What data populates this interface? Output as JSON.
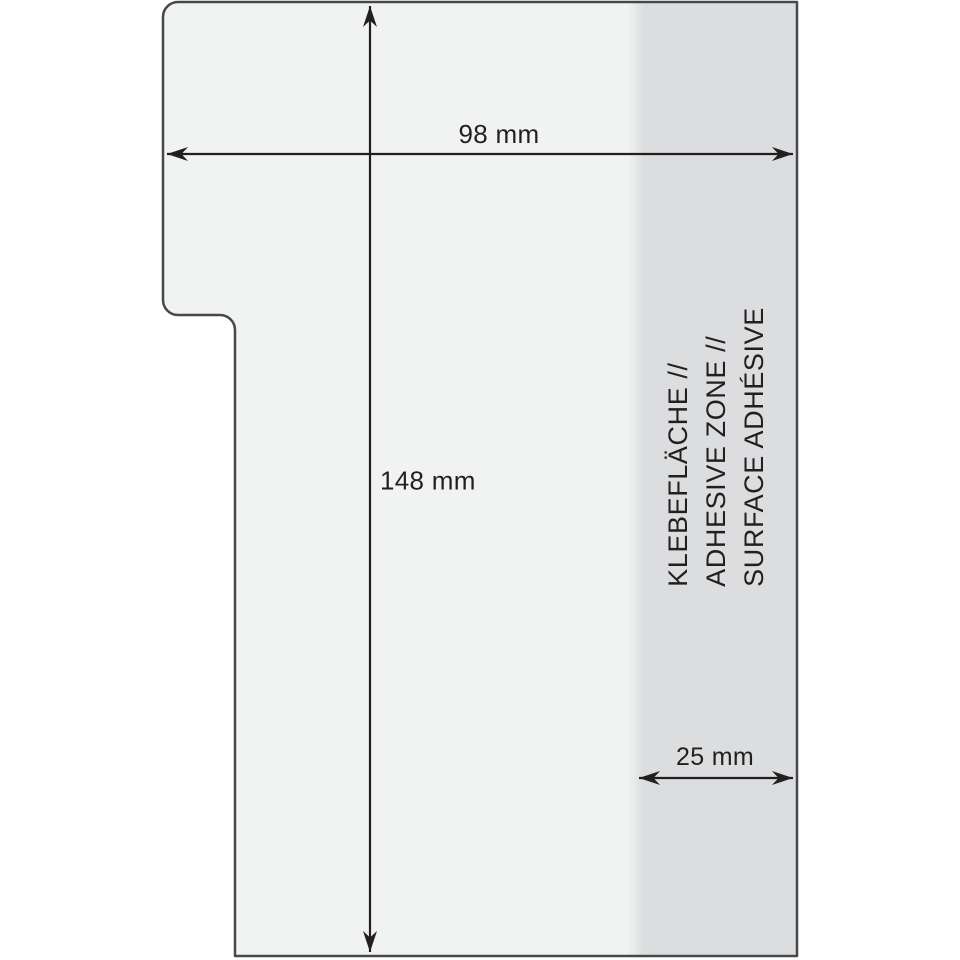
{
  "figure": {
    "title": "self-adhesive T-card pocket dimensioned drawing",
    "dimensions": {
      "width_label": "98 mm",
      "height_label": "148 mm",
      "adhesive_width_label": "25 mm"
    },
    "adhesive_zone": {
      "lines": [
        "KLEBEFLÄCHE //",
        "ADHESIVE ZONE //",
        "SURFACE ADHÉSIVE"
      ]
    },
    "colors": {
      "body_fill": "#f1f2f2",
      "adhesive_fill": "#dcddde",
      "outline": "#47484a",
      "ink": "#231f20",
      "background": "#ffffff"
    }
  }
}
